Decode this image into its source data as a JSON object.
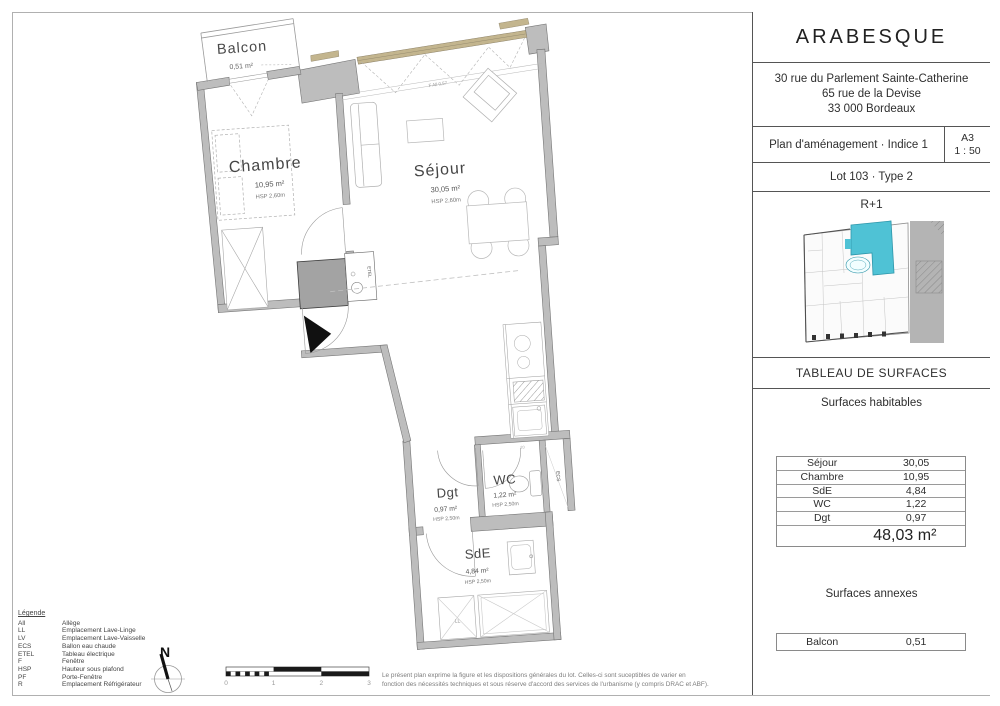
{
  "title_block": {
    "project": "ARABESQUE",
    "address_line1": "30 rue du Parlement Sainte-Catherine",
    "address_line2": "65 rue de la Devise",
    "address_line3": "33 000 Bordeaux",
    "plan_title": "Plan d'aménagement · Indice 1",
    "paper_size": "A3",
    "scale": "1 : 50",
    "lot": "Lot 103 · Type 2",
    "level": "R+1",
    "surfaces_header": "TABLEAU DE SURFACES",
    "habitable_header": "Surfaces habitables",
    "habitable_rows": [
      {
        "label": "Séjour",
        "value": "30,05"
      },
      {
        "label": "Chambre",
        "value": "10,95"
      },
      {
        "label": "SdE",
        "value": "4,84"
      },
      {
        "label": "WC",
        "value": "1,22"
      },
      {
        "label": "Dgt",
        "value": "0,97"
      }
    ],
    "habitable_total": "48,03 m²",
    "annex_header": "Surfaces annexes",
    "annex_rows": [
      {
        "label": "Balcon",
        "value": "0,51"
      }
    ]
  },
  "plan": {
    "rooms": {
      "balcon": {
        "name": "Balcon",
        "area": "0,51 m²"
      },
      "chambre": {
        "name": "Chambre",
        "area": "10,95 m²",
        "ceiling": "HSP 2,60m"
      },
      "sejour": {
        "name": "Séjour",
        "area": "30,05 m²",
        "ceiling": "HSP 2,60m"
      },
      "dgt": {
        "name": "Dgt",
        "area": "0,97 m²",
        "ceiling": "HSP 2,50m"
      },
      "wc": {
        "name": "WC",
        "area": "1,22 m²",
        "ceiling": "HSP 2,50m"
      },
      "sde": {
        "name": "SdE",
        "area": "4,84 m²",
        "ceiling": "HSP 2,50m"
      }
    },
    "annotations": {
      "etel": "ETEL",
      "ecs": "ECS",
      "ll": "LL",
      "window": "F All 0,57",
      "kitchen_dim": "20"
    }
  },
  "legend": {
    "title": "Légende",
    "items": [
      {
        "abbr": "All",
        "desc": "Allège"
      },
      {
        "abbr": "LL",
        "desc": "Emplacement Lave-Linge"
      },
      {
        "abbr": "LV",
        "desc": "Emplacement Lave-Vaisselle"
      },
      {
        "abbr": "ECS",
        "desc": "Ballon eau chaude"
      },
      {
        "abbr": "ETEL",
        "desc": "Tableau électrique"
      },
      {
        "abbr": "F",
        "desc": "Fenêtre"
      },
      {
        "abbr": "HSP",
        "desc": "Hauteur sous plafond"
      },
      {
        "abbr": "PF",
        "desc": "Porte-Fenêtre"
      },
      {
        "abbr": "R",
        "desc": "Emplacement Réfrigérateur"
      }
    ]
  },
  "compass": {
    "north": "N"
  },
  "scale_bar": {
    "tick0": "0",
    "tick1": "1",
    "tick2": "2",
    "tick3": "3"
  },
  "disclaimer": {
    "line1": "Le présent plan exprime la figure et les dispositions générales du lot. Celles-ci sont suceptibles de varier en",
    "line2": "fonction des nécessités techniques et sous réserve d'accord des services de l'urbanisme (y compris DRAC et ABF)."
  },
  "colors": {
    "wall": "#bdbdbd",
    "shaft": "#a3a3a3",
    "window_frame": "#c3b58e",
    "unit_highlight": "#4fc2d5",
    "street_gray": "#b4b4b4"
  }
}
